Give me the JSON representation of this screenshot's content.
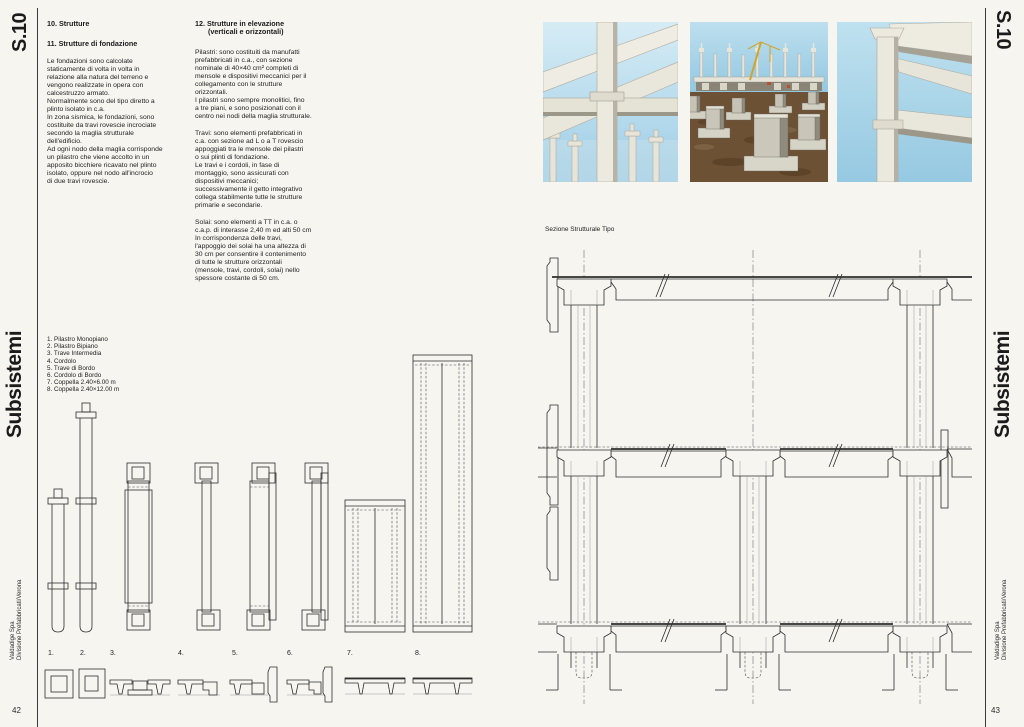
{
  "page": {
    "code": "S.10",
    "series_title": "Subsistemi",
    "publisher_line1": "Valdadige Spa",
    "publisher_line2": "Divisione Prefabbricati/Verona",
    "page_number_left": "42",
    "page_number_right": "43"
  },
  "articles": {
    "sec10_title": "10. Strutture",
    "sec11_title": "11. Strutture di fondazione",
    "sec11_body": "Le fondazioni sono calcolate\nstaticamente di volta in volta in\nrelazione alla natura del terreno e\nvengono realizzate in opera con\ncalcestruzzo armato.\nNormalmente sono del tipo diretto a\nplinto isolato in c.a.\nIn zona sismica, le fondazioni, sono\ncostituite da travi rovescie incrociate\nsecondo la maglia strutturale\ndell'edificio.\nAd ogni nodo della maglia corrisponde\nun pilastro che viene accolto in un\napposito bicchiere ricavato nel plinto\nisolato, oppure nel nodo all'incrocio\ndi due travi rovescie.",
    "sec12_title_line1": "12. Strutture in elevazione",
    "sec12_title_line2": "(verticali e orizzontali)",
    "sec12_para1": "Pilastri: sono costituiti da manufatti\nprefabbricati in c.a., con sezione\nnominale di 40×40 cm² completi di\nmensole e dispositivi meccanici per il\ncollegamento con le strutture\norizzontali.\nI pilastri sono sempre monolitici, fino\na tre piani, e sono posizionati con il\ncentro nei nodi della maglia strutturale.",
    "sec12_para2": "Travi: sono elementi prefabbricati in\nc.a. con sezione ad L o a T rovescio\nappoggiati tra le mensole dei pilastri\no sui plinti di fondazione.\nLe travi e i cordoli, in fase di\nmontaggio, sono assicurati con\ndispositivi meccanici;\nsuccessivamente il getto integrativo\ncollega stabilmente tutte le strutture\nprimarie e secondarie.",
    "sec12_para3": "Solai: sono elementi a TT in c.a. o\nc.a.p. di interasse 2,40 m ed alti 50 cm\nIn corrispondenza delle travi,\nl'appoggio dei solai ha una altezza di\n30 cm per consentire il contenimento\ndi tutte le strutture orizzontali\n(mensole, travi, cordoli, solai) nello\nspessore costante di 50 cm."
  },
  "legend": {
    "items": [
      "1. Pilastro Monopiano",
      "2. Pilastro Bipiano",
      "3. Trave Intermedia",
      "4. Cordolo",
      "5. Trave di Bordo",
      "6. Cordolo di Bordo",
      "7. Coppella 2.40×6.00 m",
      "8. Coppella 2.40×12.00 m"
    ]
  },
  "drawing": {
    "section_label": "Sezione Strutturale Tipo",
    "figure_numbers": [
      "1.",
      "2.",
      "3.",
      "4.",
      "5.",
      "6.",
      "7.",
      "8."
    ]
  },
  "colors": {
    "paper": "#f6f5f0",
    "ink": "#1b1b1b",
    "drawing_line": "#2e2e2e",
    "sky": "#a8d3e8",
    "sky_light": "#d6ecf5",
    "concrete": "#e9e6dc",
    "concrete_shadow": "#b2ae a1",
    "earth": "#6d5134",
    "crane_yellow": "#cda52f"
  }
}
